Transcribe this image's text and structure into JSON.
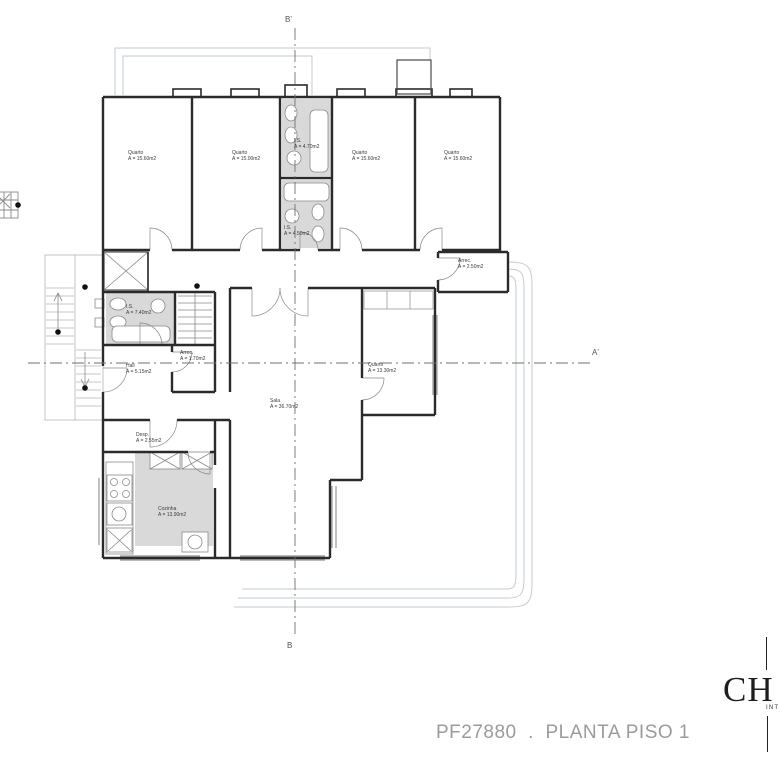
{
  "drawing": {
    "footer_title": "PF27880  .  PLANTA PISO 1",
    "logo": {
      "wordmark": "CH",
      "subtext": "INT"
    },
    "section_markers": {
      "top": "B'",
      "bottom": "B",
      "right": "A'"
    },
    "colors": {
      "wall": "#2b2b2b",
      "detail": "#8a8a8a",
      "terrace": "#c6cbd1",
      "fill": "#d9d9d9",
      "footer_text": "#9b9b9b"
    }
  },
  "rooms": [
    {
      "id": "quarto-1",
      "name": "Quarto",
      "area": "A = 15.60m2"
    },
    {
      "id": "quarto-2",
      "name": "Quarto",
      "area": "A = 15.00m2"
    },
    {
      "id": "is-1",
      "name": "I.S.",
      "area": "A = 4.70m2"
    },
    {
      "id": "quarto-3",
      "name": "Quarto",
      "area": "A = 15.60m2"
    },
    {
      "id": "quarto-4",
      "name": "Quarto",
      "area": "A = 15.60m2"
    },
    {
      "id": "is-2",
      "name": "I.S.",
      "area": "A = 4.50m2"
    },
    {
      "id": "is-3",
      "name": "I.S.",
      "area": "A = 7.40m2"
    },
    {
      "id": "arrec-1",
      "name": "Arrec.",
      "area": "A = 2.50m2"
    },
    {
      "id": "arrec-2",
      "name": "Arrec.",
      "area": "A = 1.70m2"
    },
    {
      "id": "hall",
      "name": "Hall",
      "area": "A = 5.15m2"
    },
    {
      "id": "sala",
      "name": "Sala",
      "area": "A = 36.70m2"
    },
    {
      "id": "quarto-5",
      "name": "Quarto",
      "area": "A = 13.30m2"
    },
    {
      "id": "desp",
      "name": "Desp.",
      "area": "A = 2.55m2"
    },
    {
      "id": "cozinha",
      "name": "Cozinha",
      "area": "A = 13.90m2"
    }
  ]
}
